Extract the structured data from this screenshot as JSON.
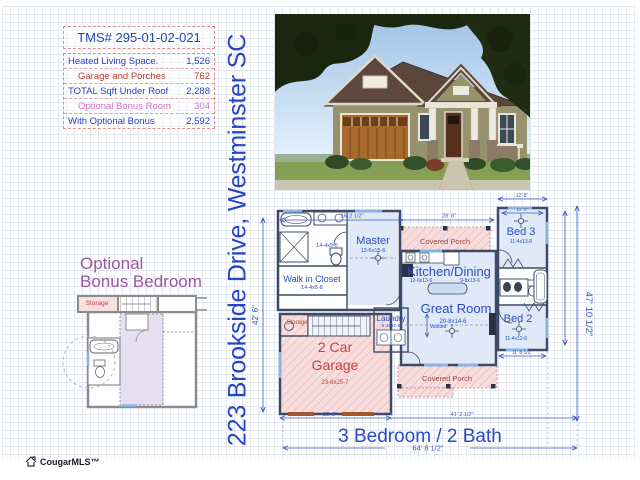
{
  "info_table": {
    "title": "TMS# 295-01-02-021",
    "rows": [
      {
        "label": "Heated Living Space.",
        "value": "1,526"
      },
      {
        "label": "Garage and Porches",
        "value": "762"
      },
      {
        "label": "TOTAL Sqft Under Roof",
        "value": "2,288"
      },
      {
        "label": "Optional Bonus Room",
        "value": "304"
      },
      {
        "label": "With Optional Bonus",
        "value": "2,592"
      }
    ]
  },
  "address": "223 Brookside Drive, Westminster SC",
  "plan": {
    "summary": "3 Bedroom / 2 Bath",
    "rooms": {
      "master": {
        "name": "Master",
        "dims": "13-6x15-6"
      },
      "master_bath_dims": "14-4x9-6",
      "wic": {
        "name": "Walk in Closet",
        "dims": "14-4x5-8"
      },
      "kitchen": {
        "name": "Kitchen/Dining",
        "dims_a": "12-0x13-6",
        "dims_b": "9-8x13-6"
      },
      "great": {
        "name": "Great Room",
        "dims": "20-8x14-6",
        "note": "Vaulted"
      },
      "bed3": {
        "name": "Bed 3",
        "dims": "11-4x13-8"
      },
      "bed2": {
        "name": "Bed 2",
        "dims": "11-4x12-6"
      },
      "laundry": {
        "name": "Laundry",
        "dims": "5-10x7-8"
      },
      "garage": {
        "line1": "2 Car",
        "line2": "Garage",
        "dims": "23-6x25-7"
      },
      "storage": "Storage",
      "porch_top": "Covered Porch",
      "porch_bottom": "Covered Porch"
    },
    "dims": {
      "left": "42' 6\"",
      "right": "47' 10 1/2\"",
      "top_left": "26' 2 1/2\"",
      "top_right": "28' 8\"",
      "wing_top": "12' 8\"",
      "wing_inner": "11' 4\"",
      "bottom_garage": "23' 6\"",
      "bottom_main": "41' 2 1/2\"",
      "total_width": "64' 8 1/2\"",
      "bed2_width": "11' 8 1/2\""
    },
    "colors": {
      "label_blue": "#2a4bc7",
      "dim_blue": "#3a57c4",
      "label_red": "#c64040",
      "porch_label": "#9c4a42",
      "porch_fill": "#f8dddd"
    }
  },
  "bonus": {
    "title1": "Optional",
    "title2": "Bonus Bedroom",
    "storage": "Storage"
  },
  "logo": {
    "text": "CougarMLS™"
  }
}
